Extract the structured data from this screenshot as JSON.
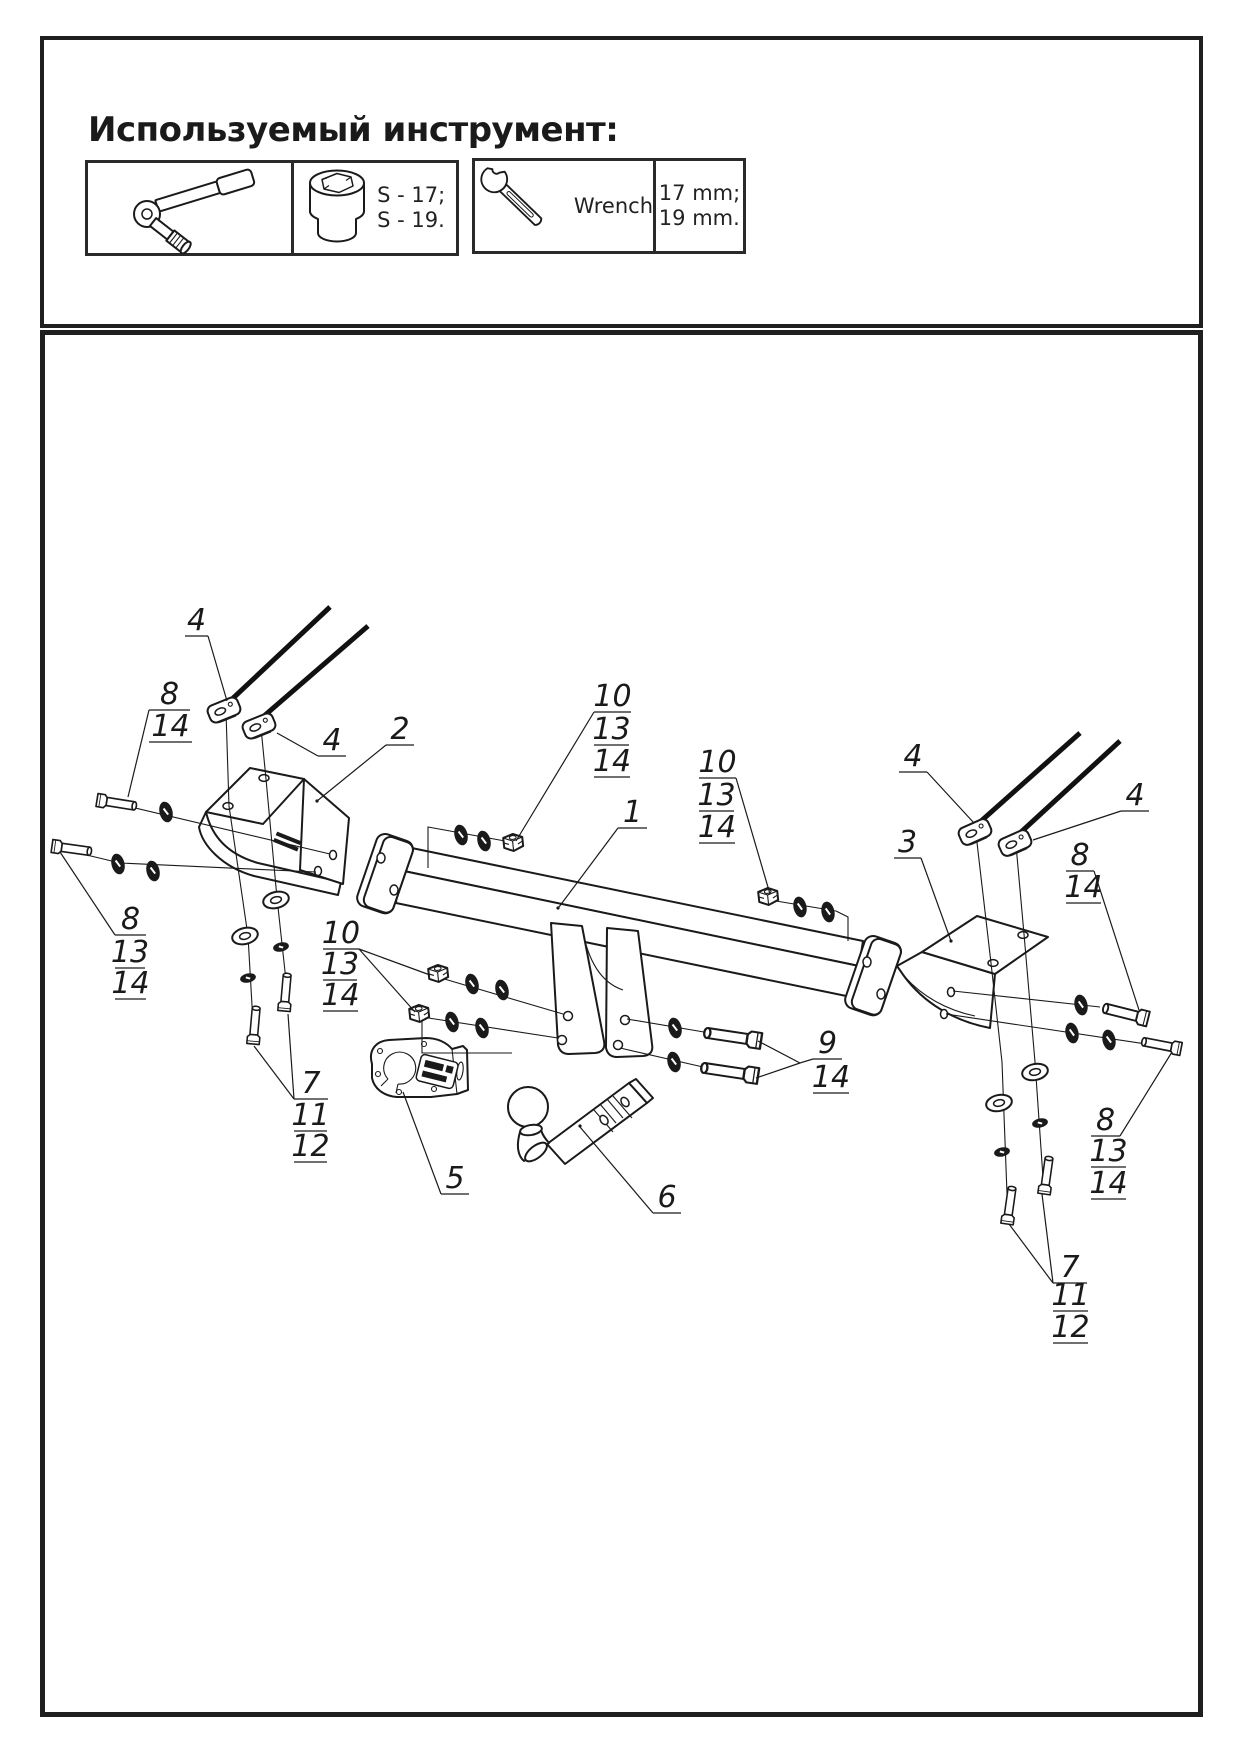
{
  "colors": {
    "ink": "#1a1a1a",
    "paper": "#ffffff",
    "border": "#1f1f1f"
  },
  "header": {
    "title": "Используемый инструмент:"
  },
  "tools": {
    "ratchet_icon": "ratchet-socket-wrench-icon",
    "socket_icon": "socket-head-icon",
    "socket_sizes": "S - 17;\nS - 19.",
    "wrench_icon": "open-end-wrench-icon",
    "wrench_label": "Wrench",
    "wrench_sizes": "17 mm;\n19 mm."
  },
  "diagram": {
    "description": "Exploded isometric view of a towbar assembly with numbered callouts",
    "part_numbers_shown": [
      "1",
      "2",
      "3",
      "4",
      "5",
      "6",
      "7",
      "8",
      "9",
      "10",
      "11",
      "12",
      "13",
      "14"
    ],
    "callouts": [
      {
        "id": "4a",
        "lines": [
          {
            "n": "4",
            "x1": 185,
            "x2": 208,
            "y": 636
          }
        ],
        "leaders": [
          "208,636 227,701"
        ]
      },
      {
        "id": "8-14a",
        "lines": [
          {
            "n": "8",
            "x1": 149,
            "x2": 190,
            "y": 710
          },
          {
            "n": "14",
            "x1": 149,
            "x2": 192,
            "y": 742
          }
        ],
        "leaders": [
          "149,710 128,797"
        ]
      },
      {
        "id": "4b",
        "lines": [
          {
            "n": "4",
            "x1": 318,
            "x2": 346,
            "y": 756
          }
        ],
        "leaders": [
          "318,756 277,733"
        ]
      },
      {
        "id": "2",
        "lines": [
          {
            "n": "2",
            "x1": 386,
            "x2": 414,
            "y": 745
          }
        ],
        "leaders": [
          "386,745 317,801"
        ]
      },
      {
        "id": "10-13-14a",
        "lines": [
          {
            "n": "10",
            "x1": 594,
            "x2": 631,
            "y": 712
          },
          {
            "n": "13",
            "x1": 594,
            "x2": 629,
            "y": 745
          },
          {
            "n": "14",
            "x1": 594,
            "x2": 630,
            "y": 777
          }
        ],
        "leaders": [
          "594,712 516,841"
        ]
      },
      {
        "id": "1",
        "lines": [
          {
            "n": "1",
            "x1": 618,
            "x2": 647,
            "y": 828
          }
        ],
        "leaders": [
          "618,828 559,907"
        ]
      },
      {
        "id": "10-13-14b",
        "lines": [
          {
            "n": "10",
            "x1": 699,
            "x2": 736,
            "y": 778
          },
          {
            "n": "13",
            "x1": 699,
            "x2": 734,
            "y": 811
          },
          {
            "n": "14",
            "x1": 699,
            "x2": 735,
            "y": 843
          }
        ],
        "leaders": [
          "736,778 770,894"
        ]
      },
      {
        "id": "4c",
        "lines": [
          {
            "n": "4",
            "x1": 899,
            "x2": 927,
            "y": 772
          }
        ],
        "leaders": [
          "927,772 974,823"
        ]
      },
      {
        "id": "4d",
        "lines": [
          {
            "n": "4",
            "x1": 1121,
            "x2": 1149,
            "y": 811
          }
        ],
        "leaders": [
          "1121,811 1033,840"
        ]
      },
      {
        "id": "3",
        "lines": [
          {
            "n": "3",
            "x1": 894,
            "x2": 921,
            "y": 858
          }
        ],
        "leaders": [
          "921,858 951,941"
        ]
      },
      {
        "id": "8-14b",
        "lines": [
          {
            "n": "8",
            "x1": 1066,
            "x2": 1094,
            "y": 871
          },
          {
            "n": "14",
            "x1": 1066,
            "x2": 1101,
            "y": 903
          }
        ],
        "leaders": [
          "1094,871 1139,1010"
        ]
      },
      {
        "id": "8-13-14a",
        "lines": [
          {
            "n": "8",
            "x1": 115,
            "x2": 146,
            "y": 935
          },
          {
            "n": "13",
            "x1": 115,
            "x2": 145,
            "y": 968
          },
          {
            "n": "14",
            "x1": 115,
            "x2": 146,
            "y": 999
          }
        ],
        "leaders": [
          "115,935 60,852"
        ]
      },
      {
        "id": "9-14",
        "lines": [
          {
            "n": "9",
            "x1": 813,
            "x2": 842,
            "y": 1059
          },
          {
            "n": "14",
            "x1": 813,
            "x2": 849,
            "y": 1093
          }
        ],
        "leaders": [
          "813,1059 800,1063 758,1041",
          "800,1063 756,1078"
        ]
      },
      {
        "id": "10-13-14c",
        "lines": [
          {
            "n": "10",
            "x1": 323,
            "x2": 359,
            "y": 949
          },
          {
            "n": "13",
            "x1": 323,
            "x2": 357,
            "y": 980
          },
          {
            "n": "14",
            "x1": 323,
            "x2": 358,
            "y": 1011
          }
        ],
        "leaders": [
          "359,949 430,975",
          "359,949 415,1012"
        ]
      },
      {
        "id": "7-11-12a",
        "lines": [
          {
            "n": "7",
            "x1": 294,
            "x2": 328,
            "y": 1099
          },
          {
            "n": "11",
            "x1": 294,
            "x2": 327,
            "y": 1131
          },
          {
            "n": "12",
            "x1": 294,
            "x2": 327,
            "y": 1162
          }
        ],
        "leaders": [
          "294,1099 254,1046",
          "294,1099 288,1014"
        ]
      },
      {
        "id": "5",
        "lines": [
          {
            "n": "5",
            "x1": 441,
            "x2": 469,
            "y": 1194
          }
        ],
        "leaders": [
          "441,1194 403,1092"
        ]
      },
      {
        "id": "6",
        "lines": [
          {
            "n": "6",
            "x1": 653,
            "x2": 681,
            "y": 1213
          }
        ],
        "leaders": [
          "653,1213 580,1127"
        ]
      },
      {
        "id": "8-13-14b",
        "lines": [
          {
            "n": "8",
            "x1": 1091,
            "x2": 1120,
            "y": 1136
          },
          {
            "n": "13",
            "x1": 1091,
            "x2": 1126,
            "y": 1167
          },
          {
            "n": "14",
            "x1": 1091,
            "x2": 1126,
            "y": 1199
          }
        ],
        "leaders": [
          "1120,1136 1172,1052"
        ]
      },
      {
        "id": "7-11-12b",
        "lines": [
          {
            "n": "7",
            "x1": 1053,
            "x2": 1087,
            "y": 1283
          },
          {
            "n": "11",
            "x1": 1053,
            "x2": 1088,
            "y": 1311
          },
          {
            "n": "12",
            "x1": 1053,
            "x2": 1088,
            "y": 1343
          }
        ],
        "leaders": [
          "1053,1283 1042,1194",
          "1053,1283 1009,1224"
        ]
      }
    ]
  }
}
